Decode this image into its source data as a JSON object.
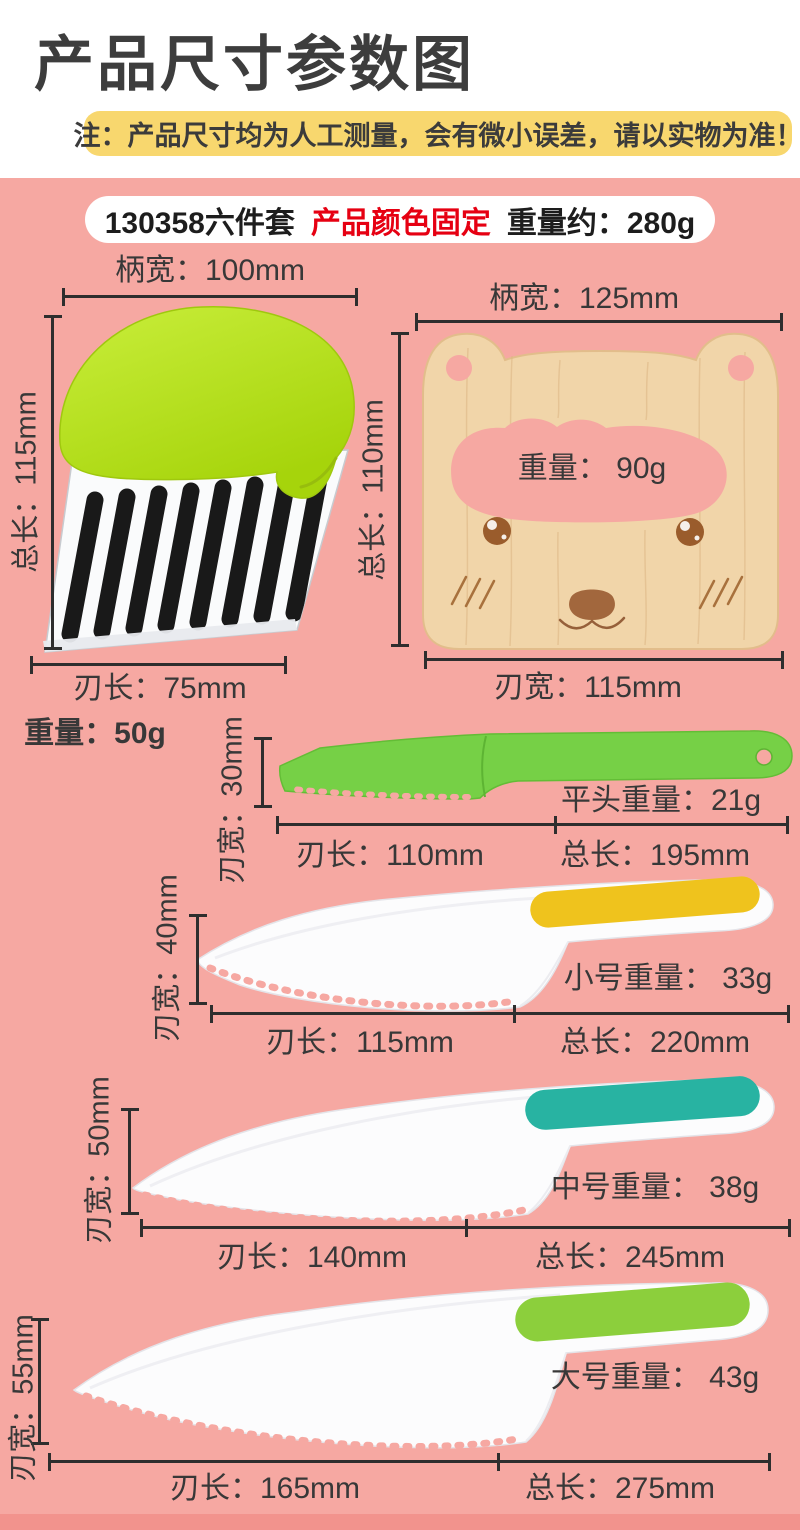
{
  "header": {
    "title": "产品尺寸参数图",
    "note": "注：产品尺寸均为人工测量，会有微小误差，请以实物为准！",
    "info": {
      "model": "130358六件套",
      "color_fixed": "产品颜色固定",
      "weight": "重量约：280g"
    }
  },
  "products": {
    "crinkle_cutter": {
      "handle_width": "柄宽：100mm",
      "total_length": "总长：115mm",
      "blade_length": "刃长：75mm",
      "weight": "重量：50g"
    },
    "bear_knife": {
      "handle_width": "柄宽：125mm",
      "total_length": "总长：110mm",
      "weight": "重量： 90g",
      "blade_width": "刃宽：115mm"
    },
    "flat_knife": {
      "blade_width": "刃宽：30mm",
      "weight": "平头重量：21g",
      "blade_length": "刃长：110mm",
      "total_length": "总长：195mm"
    },
    "small_knife": {
      "blade_width": "刃宽：40mm",
      "weight": "小号重量： 33g",
      "blade_length": "刃长：115mm",
      "total_length": "总长：220mm"
    },
    "medium_knife": {
      "blade_width": "刃宽：50mm",
      "weight": "中号重量： 38g",
      "blade_length": "刃长：140mm",
      "total_length": "总长：245mm"
    },
    "large_knife": {
      "blade_width": "刃宽：55mm",
      "weight": "大号重量： 43g",
      "blade_length": "刃长：165mm",
      "total_length": "总长：275mm"
    }
  },
  "colors": {
    "background_pink": "#f6a8a2",
    "bottom_strip_pink": "#f2938d",
    "note_highlight_yellow": "#f8d76e",
    "text_dark": "#3a3a3a",
    "accent_red": "#e60012",
    "crinkle_handle_green": "#b6e017",
    "flat_knife_green": "#76d046",
    "grip_yellow": "#efc31d",
    "grip_teal": "#28b3a2",
    "grip_green": "#8ccf3c",
    "wood": "#f1d5a9",
    "dimension_line": "#2e2e2e"
  }
}
